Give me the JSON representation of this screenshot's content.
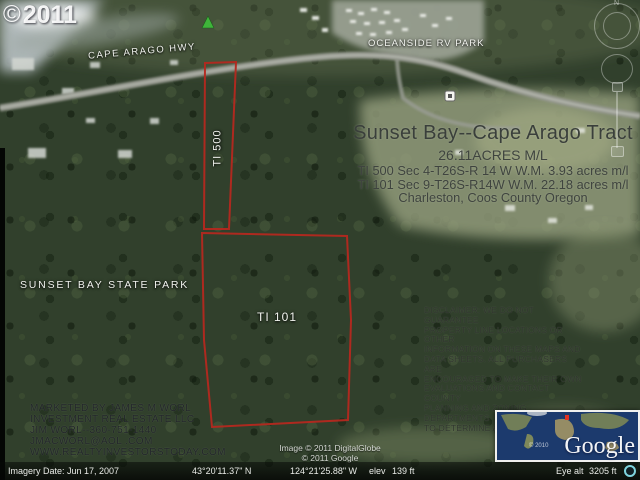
{
  "watermark": {
    "symbol": "©",
    "year": "2011"
  },
  "map_labels": {
    "highway": "CAPE ARAGO HWY",
    "rv_park": "OCEANSIDE RV PARK",
    "state_park": "SUNSET BAY STATE PARK",
    "parcel_small": "TI 500",
    "parcel_large": "TI 101"
  },
  "listing": {
    "title": "Sunset Bay--Cape Arago Tract",
    "acreage": "26.11ACRES M/L",
    "parcel1": "TI 500 Sec 4-T26S-R 14 W W.M. 3.93 acres m/l",
    "parcel2": "TI 101 Sec 9-T26S-R14W W.M. 22.18 acres m/l",
    "location": "Charleston, Coos County Oregon"
  },
  "disclaimer": {
    "lines": [
      "DISCLAIMER: WE DO NOT GUARANTEE",
      "PROPERTY LINE LOCATIONS OR OTHER",
      "INFORMATION ON THESE MAPS AND",
      "DATA SHEETS. ALL PURCHASERS ARE",
      "ENCOURAGED TO MAKE THEIR OWN",
      "EVALUATIONS AND CONTACT COUNTY",
      "PLANNING AND ZONING DEPARTMENTS",
      "TO DETERMINE ALLOWABLE USES"
    ]
  },
  "marketing": {
    "lines": [
      "MARKETED BY JAMES M WORL",
      "INVESTMENT REAL ESTATE LLC",
      "JIM WORL--360-751-1440",
      "JMACWORL@AOL .COM",
      "WWW.REALTYINVESTORSTODAY.COM"
    ]
  },
  "credits": {
    "imagery": "Image © 2011 DigitalGlobe",
    "google": "© 2011 Google"
  },
  "status_bar": {
    "imagery_date": "Imagery Date: Jun 17, 2007",
    "latitude": "43°20'11.37\" N",
    "longitude": "124°21'25.88\" W",
    "elev_label": "elev",
    "elevation": "139 ft",
    "eye_alt_label": "Eye alt",
    "eye_altitude": "3205 ft"
  },
  "overview_map": {
    "logo": "Google",
    "credit": "© 2010"
  },
  "nav": {
    "compass_n": "N"
  },
  "colors": {
    "parcel_outline": "#b5281f",
    "label_white": "#f1f3ee",
    "marker_green": "#3fb53a",
    "status_bg": "#060906"
  }
}
